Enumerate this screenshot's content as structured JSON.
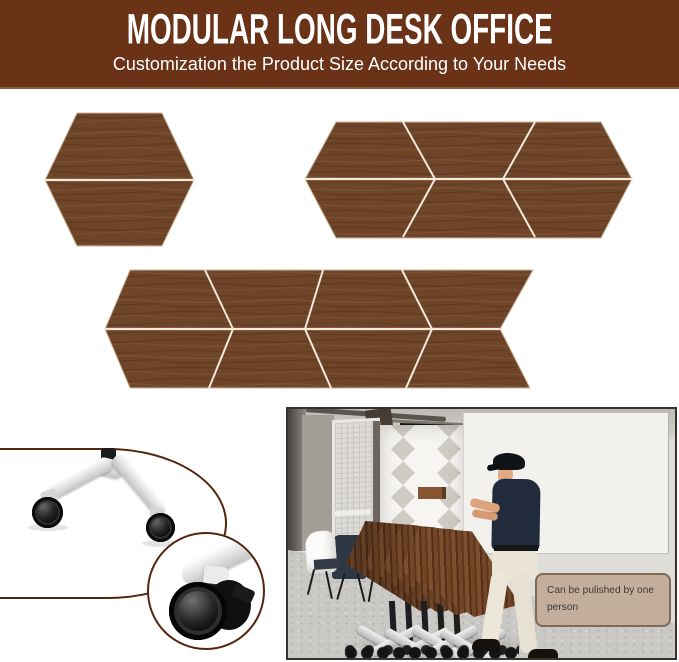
{
  "banner": {
    "title": "MODULAR LONG DESK OFFICE",
    "subtitle": "Customization the Product Size According to Your Needs",
    "background_color": "#6a3217",
    "text_color": "#ffffff"
  },
  "desk_configurations": {
    "wood_color": "#6f4529",
    "seam_color": "#f3e9da",
    "figures": [
      {
        "name": "hexagon-config",
        "segments": 2
      },
      {
        "name": "long-hexagon-config",
        "segments": 6
      },
      {
        "name": "chevron-strip-config",
        "segments": 8
      }
    ]
  },
  "insets": {
    "border_color": "#52260f",
    "figures": [
      {
        "name": "caster-leg-inset"
      },
      {
        "name": "caster-closeup-inset"
      }
    ]
  },
  "photo": {
    "callout": {
      "text": "Can be pulished by one person",
      "background_color": "#c3ae9b",
      "border_color": "#7e6a57",
      "text_color": "#3e3933"
    }
  }
}
